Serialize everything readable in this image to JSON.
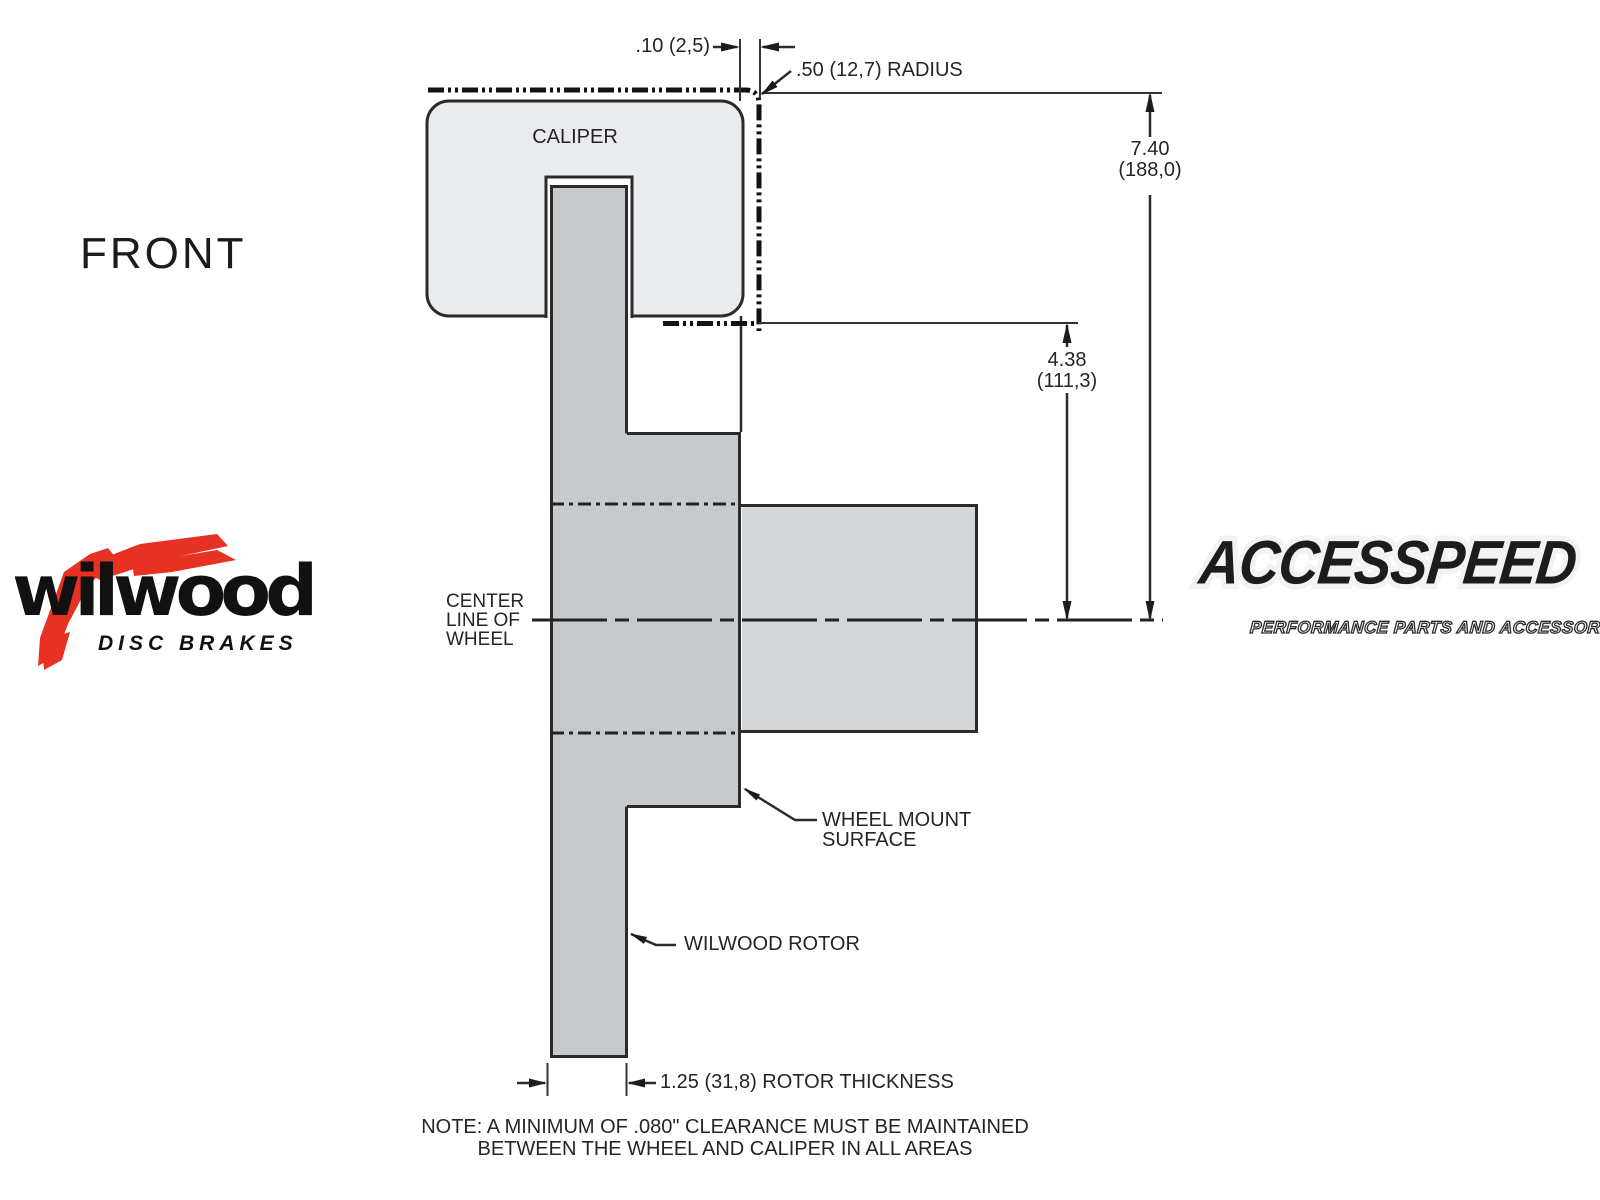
{
  "drawing": {
    "view_label": "FRONT",
    "caliper_label": "CALIPER",
    "centerline_label_lines": [
      "CENTER",
      "LINE OF",
      "WHEEL"
    ],
    "wheel_mount_label_lines": [
      "WHEEL MOUNT",
      "SURFACE"
    ],
    "rotor_label": "WILWOOD ROTOR",
    "dims": {
      "caliper_wheel_gap": ".10 (2,5)",
      "corner_radius": ".50 (12,7) RADIUS",
      "overall_height": [
        "7.40",
        "(188,0)"
      ],
      "mount_to_center": [
        "4.38",
        "(111,3)"
      ],
      "rotor_thickness": "1.25 (31,8) ROTOR THICKNESS"
    },
    "note_lines": [
      "NOTE: A MINIMUM OF .080\" CLEARANCE MUST BE MAINTAINED",
      "BETWEEN THE WHEEL AND CALIPER IN ALL AREAS"
    ]
  },
  "logos": {
    "wilwood": {
      "wordmark": "wilwood",
      "tagline": "DISC BRAKES"
    },
    "accesspeed": {
      "wordmark": "ACCESSPEED",
      "tagline": "PERFORMANCE PARTS AND ACCESSORIES"
    }
  },
  "colors": {
    "background": "#ffffff",
    "line": "#2b2b2b",
    "caliper_fill": "#e9ebee",
    "rotor_fill": "#c6cacd",
    "hub_fill": "#d3d7da",
    "wilwood_red": "#e63123",
    "logo_black": "#1c1c1f"
  }
}
